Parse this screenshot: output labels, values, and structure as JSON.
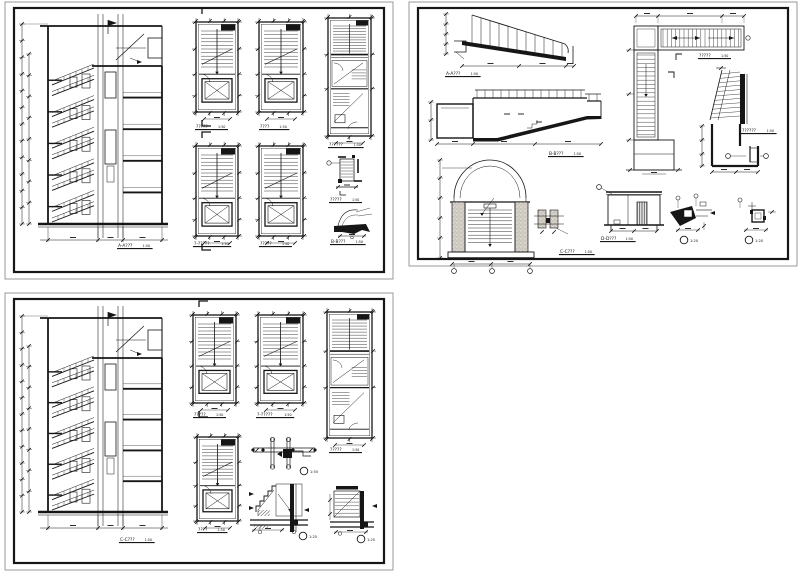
{
  "page": {
    "width": 800,
    "height": 574,
    "background": "#ffffff",
    "ink": "#161616",
    "frame_gray": "#9a9a9a",
    "poche": "#cbc5bc"
  },
  "panels": [
    {
      "id": "top-left",
      "frame": {
        "x": 5,
        "y": 2,
        "w": 388,
        "h": 277
      },
      "figures": [
        {
          "name": "stair-section",
          "type": "bigSection",
          "x": 20,
          "y": 10,
          "w": 150,
          "h": 238,
          "label": {
            "text": "A-A???",
            "scale": "1:50",
            "x": 118,
            "y": 247
          }
        },
        {
          "name": "stair-plan-1",
          "type": "plan",
          "x": 196,
          "y": 22,
          "w": 42,
          "h": 90,
          "cut": true,
          "label": {
            "text": "?????",
            "scale": "1:50",
            "x": 196,
            "y": 128
          }
        },
        {
          "name": "stair-plan-2",
          "type": "plan",
          "x": 259,
          "y": 22,
          "w": 44,
          "h": 90,
          "label": {
            "text": "????",
            "scale": "1:50",
            "x": 260,
            "y": 128
          }
        },
        {
          "name": "stair-plan-3",
          "type": "plan",
          "x": 196,
          "y": 146,
          "w": 42,
          "h": 90,
          "cut": true,
          "label": {
            "text": "?-?????",
            "scale": "1:50",
            "x": 194,
            "y": 245
          }
        },
        {
          "name": "stair-plan-4",
          "type": "plan",
          "x": 259,
          "y": 146,
          "w": 44,
          "h": 90,
          "label": {
            "text": "?????",
            "scale": "1:50",
            "x": 260,
            "y": 245
          }
        },
        {
          "name": "stair-plan-tall",
          "type": "planTall",
          "x": 328,
          "y": 18,
          "w": 43,
          "h": 118,
          "label": {
            "text": "??????",
            "scale": "1:50",
            "x": 329,
            "y": 146
          }
        },
        {
          "name": "landing-section-detail",
          "type": "landingSec",
          "x": 332,
          "y": 155,
          "w": 30,
          "h": 40,
          "label": {
            "text": "?????",
            "scale": "1:50",
            "x": 330,
            "y": 201
          }
        },
        {
          "name": "section-b-b-detail",
          "type": "blobDetail",
          "x": 332,
          "y": 206,
          "w": 40,
          "h": 32,
          "label": {
            "text": "B-B???",
            "scale": "1:50",
            "x": 331,
            "y": 243
          }
        }
      ]
    },
    {
      "id": "top-right",
      "frame": {
        "x": 409,
        "y": 2,
        "w": 388,
        "h": 264
      },
      "figures": [
        {
          "name": "ramp-section",
          "type": "rampSection",
          "x": 444,
          "y": 12,
          "w": 136,
          "h": 58,
          "label": {
            "text": "A-A???",
            "scale": "1:50",
            "x": 446,
            "y": 75
          }
        },
        {
          "name": "long-section",
          "type": "longSection",
          "x": 435,
          "y": 84,
          "w": 168,
          "h": 60,
          "label": {
            "text": "B-B???",
            "scale": "1:50",
            "x": 549,
            "y": 155
          }
        },
        {
          "name": "arched-entry-section",
          "type": "archFigure",
          "x": 446,
          "y": 154,
          "w": 118,
          "h": 106,
          "label": {
            "text": "C-C???",
            "scale": "1:50",
            "x": 560,
            "y": 253
          }
        },
        {
          "name": "box-elevation",
          "type": "boxElev",
          "x": 606,
          "y": 190,
          "w": 56,
          "h": 44,
          "label": {
            "text": "D-D???",
            "scale": "1:50",
            "x": 601,
            "y": 240
          }
        },
        {
          "name": "l-shaped-plan",
          "type": "lPlan",
          "x": 622,
          "y": 14,
          "w": 126,
          "h": 168,
          "label": {
            "text": "?????",
            "scale": "1:50",
            "x": 699,
            "y": 57
          }
        },
        {
          "name": "wall-section-detail",
          "type": "vSection",
          "x": 706,
          "y": 68,
          "w": 58,
          "h": 112,
          "label": {
            "text": "??????",
            "scale": "1:50",
            "x": 742,
            "y": 132
          }
        },
        {
          "name": "footing-detail-1",
          "type": "smallDetail",
          "x": 666,
          "y": 196,
          "w": 54,
          "h": 40,
          "circle": {
            "scale": "1:20",
            "x": 684,
            "y": 240
          }
        },
        {
          "name": "footing-detail-2",
          "type": "smallDetail2",
          "x": 734,
          "y": 198,
          "w": 44,
          "h": 36,
          "circle": {
            "scale": "1:20",
            "x": 749,
            "y": 240
          }
        }
      ]
    },
    {
      "id": "bottom-left",
      "frame": {
        "x": 5,
        "y": 293,
        "w": 388,
        "h": 277
      },
      "figures": [
        {
          "name": "stair-section",
          "type": "bigSection",
          "x": 20,
          "y": 302,
          "w": 150,
          "h": 234,
          "label": {
            "text": "C-C???",
            "scale": "1:50",
            "x": 120,
            "y": 541
          }
        },
        {
          "name": "stair-plan-1",
          "type": "plan",
          "x": 193,
          "y": 315,
          "w": 43,
          "h": 88,
          "cut": true,
          "label": {
            "text": "?????",
            "scale": "1:50",
            "x": 194,
            "y": 416
          }
        },
        {
          "name": "stair-plan-2",
          "type": "plan",
          "x": 258,
          "y": 315,
          "w": 45,
          "h": 88,
          "label": {
            "text": "?-?????",
            "scale": "1:50",
            "x": 257,
            "y": 416
          }
        },
        {
          "name": "stair-plan-tall",
          "type": "planTall",
          "x": 327,
          "y": 312,
          "w": 45,
          "h": 126,
          "label": {
            "text": "?????",
            "scale": "1:50",
            "x": 330,
            "y": 451
          }
        },
        {
          "name": "stair-plan-3",
          "type": "plan",
          "x": 197,
          "y": 437,
          "w": 41,
          "h": 84,
          "label": {
            "text": "????",
            "scale": "1:50",
            "x": 198,
            "y": 531
          }
        },
        {
          "name": "landing-beam-detail",
          "type": "landingDetail",
          "x": 253,
          "y": 438,
          "w": 66,
          "h": 32,
          "circle": {
            "scale": "1:50",
            "x": 304,
            "y": 471
          }
        },
        {
          "name": "stair-base-detail-1",
          "type": "stairDetail",
          "x": 248,
          "y": 482,
          "w": 62,
          "h": 54,
          "circle": {
            "scale": "1:25",
            "x": 303,
            "y": 536
          }
        },
        {
          "name": "stair-base-detail-2",
          "type": "stairDetail2",
          "x": 328,
          "y": 486,
          "w": 50,
          "h": 50,
          "circle": {
            "scale": "1:25",
            "x": 361,
            "y": 539
          }
        }
      ]
    }
  ]
}
